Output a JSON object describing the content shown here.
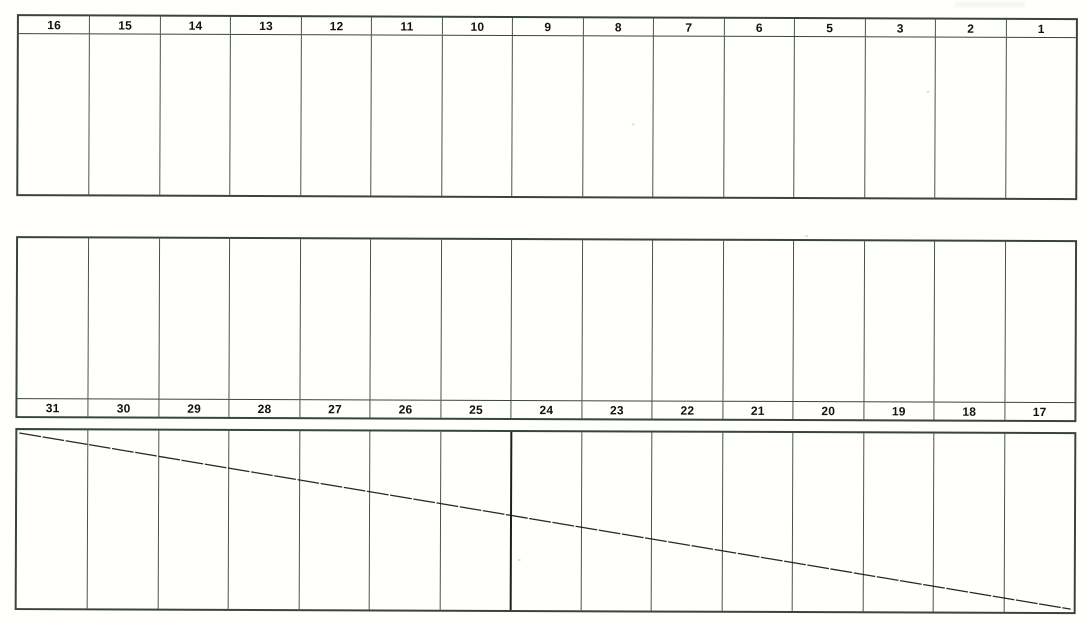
{
  "colors": {
    "paper": "#ffffff",
    "outer_line": "#39443d",
    "inner_line": "#49524a",
    "number_ink": "#121212",
    "diagonal_ink": "#151515"
  },
  "bands": {
    "top": {
      "headers": [
        "16",
        "15",
        "14",
        "13",
        "12",
        "11",
        "10",
        "9",
        "8",
        "7",
        "6",
        "5",
        "3",
        "2",
        "1"
      ]
    },
    "middle": {
      "headers": [
        "31",
        "30",
        "29",
        "28",
        "27",
        "26",
        "25",
        "24",
        "23",
        "22",
        "21",
        "20",
        "19",
        "18",
        "17"
      ]
    },
    "bottom": {
      "columns": 15,
      "diagonal_strike": true,
      "heavy_divider_after_column": 7
    }
  }
}
